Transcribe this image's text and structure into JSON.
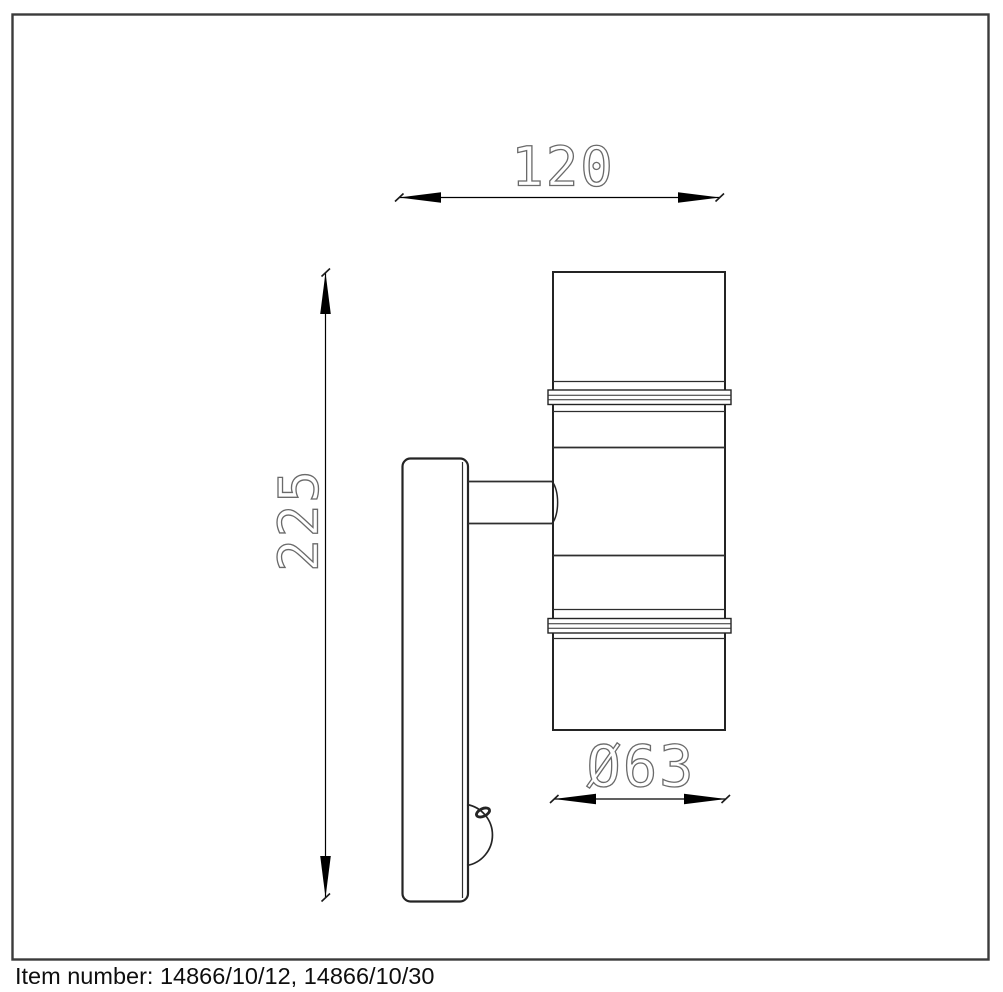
{
  "drawing": {
    "title": "wall-spot-light-dimension-drawing",
    "dimensions": {
      "width_label": "120",
      "height_label": "225",
      "diameter_label": "Ø63"
    },
    "caption": "Item number: 14866/10/12, 14866/10/30",
    "colors": {
      "background": "#ffffff",
      "border": "#3b3b3b",
      "outline": "#242424",
      "dimension": "#000000",
      "dim_text": "#6a6a6a",
      "caption_text": "#0e0e0e"
    }
  }
}
